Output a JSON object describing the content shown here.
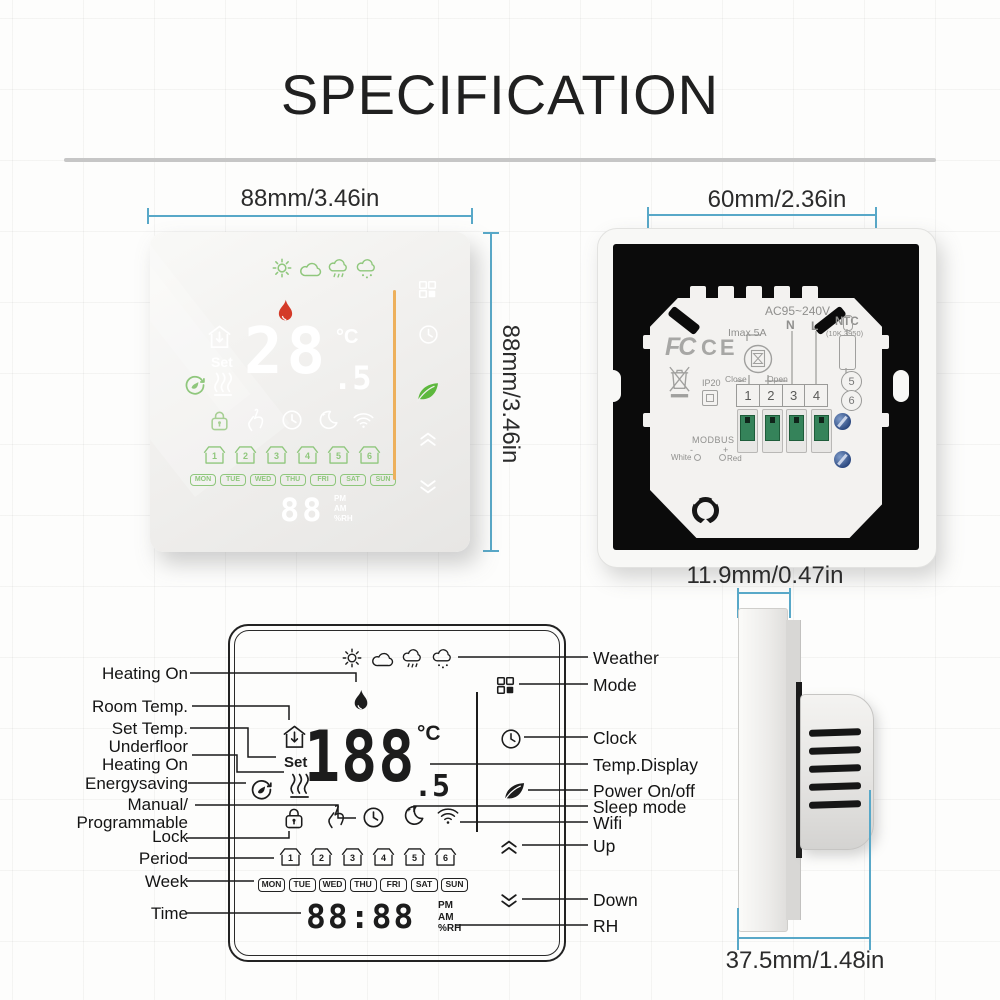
{
  "title": "SPECIFICATION",
  "colors": {
    "dimension_blue": "#58a8c8",
    "display_green": "#8fc77c",
    "flame_red": "#d43a28",
    "divider_orange": "#edb05c",
    "leaf_green": "#5db83d"
  },
  "front_view": {
    "width_label": "88mm/3.46in",
    "height_label": "88mm/3.46in",
    "set_label": "Set",
    "temp_int": "28",
    "temp_dec": ".5",
    "temp_unit": "°C",
    "time_digits": "88",
    "pm": "PM",
    "am": "AM",
    "rh": "%RH",
    "week": [
      "MON",
      "TUE",
      "WED",
      "THU",
      "FRI",
      "SAT",
      "SUN"
    ],
    "periods": [
      "1",
      "2",
      "3",
      "4",
      "5",
      "6"
    ]
  },
  "back_view": {
    "width_label": "60mm/2.36in",
    "voltage": "AC95~240V",
    "imax": "Imax 5A",
    "neutral": "N",
    "live": "L",
    "ntc": "NTC",
    "ntc_spec": "(10K 3950)",
    "close_label": "Close",
    "open_label": "Open",
    "terminals": [
      "1",
      "2",
      "3",
      "4"
    ],
    "sensor_terminals": [
      "5",
      "6"
    ],
    "ip_rating": "IP20",
    "modbus": "MODBUS",
    "modbus_white": "White",
    "modbus_red": "Red",
    "modbus_minus": "-",
    "modbus_plus": "+",
    "fcc": "FC",
    "ce": "CE"
  },
  "diagram": {
    "set_label": "Set",
    "temp_int": "188",
    "temp_dec": ".5",
    "temp_unit": "°C",
    "time_digits": "88:88",
    "pm": "PM",
    "am": "AM",
    "rh_unit": "%RH",
    "week": [
      "MON",
      "TUE",
      "WED",
      "THU",
      "FRI",
      "SAT",
      "SUN"
    ],
    "periods": [
      "1",
      "2",
      "3",
      "4",
      "5",
      "6"
    ],
    "left_labels": {
      "heating_on": "Heating On",
      "room_temp": "Room Temp.",
      "set_temp": "Set Temp.",
      "underfloor_1": "Underfloor",
      "underfloor_2": "Heating On",
      "energysaving": "Energysaving",
      "manual_1": "Manual/",
      "manual_2": "Programmable",
      "lock": "Lock",
      "period": "Period",
      "week": "Week",
      "time": "Time"
    },
    "right_labels": {
      "weather": "Weather",
      "mode": "Mode",
      "clock": "Clock",
      "temp_display": "Temp.Display",
      "power": "Power On/off",
      "sleep": "Sleep mode",
      "wifi": "Wifi",
      "up": "Up",
      "down": "Down",
      "rh": "RH"
    }
  },
  "side_view": {
    "top_label": "11.9mm/0.47in",
    "bottom_label": "37.5mm/1.48in"
  }
}
